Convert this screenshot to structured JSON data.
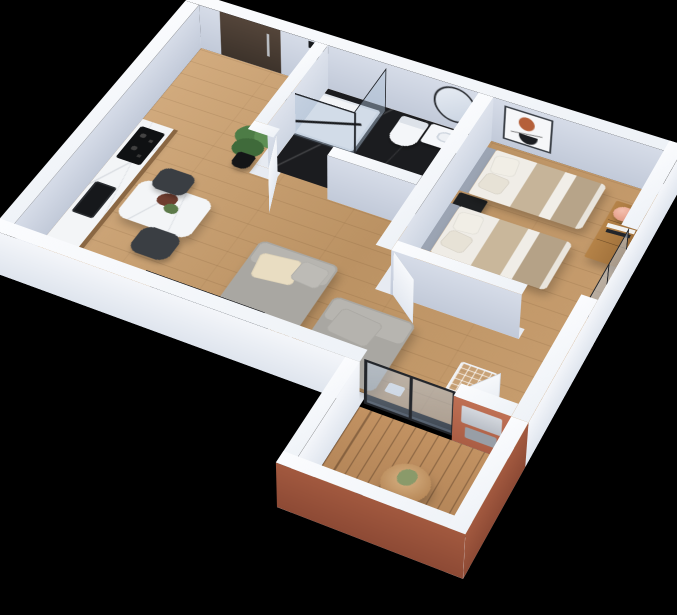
{
  "scene": {
    "kind": "3d-isometric-floor-plan-render",
    "background": "#000000",
    "rooms": [
      {
        "id": "entry-hall",
        "floor": "wood",
        "items": [
          "entrance-door",
          "potted-plant"
        ]
      },
      {
        "id": "bathroom",
        "floor": "black-marble",
        "items": [
          "walk-in-shower",
          "toilet",
          "vanity-sink",
          "round-mirror",
          "bathroom-door"
        ]
      },
      {
        "id": "kitchen-dining",
        "floor": "wood",
        "items": [
          "marble-counter",
          "cooktop",
          "sink",
          "dining-table",
          "flowers",
          "chair",
          "chair"
        ]
      },
      {
        "id": "living-room",
        "floor": "wood",
        "items": [
          "lounge-sofa",
          "lounge-sofa",
          "wire-coffee-table",
          "wire-side-table",
          "tv-panel",
          "balcony-door"
        ]
      },
      {
        "id": "bedroom",
        "floor": "wood",
        "items": [
          "single-bed",
          "single-bed",
          "nightstand",
          "dresser",
          "table-lamp",
          "photo-frames",
          "wall-art",
          "window"
        ]
      },
      {
        "id": "balcony",
        "floor": "deck",
        "items": [
          "round-table",
          "dried-plant",
          "lounge-chair",
          "ac-unit",
          "glass-doors"
        ]
      }
    ]
  },
  "palette": {
    "background": "#000000",
    "wall_top": "#f8fafc",
    "wall_footprint": "#e7ebf2",
    "wall_inner": "#c7cfdd",
    "wall_outer": "#edf1f7",
    "wood_floor": "#c69d70",
    "bath_floor": "#1b1c1f",
    "deck_floor": "#b4865a",
    "terracotta": "#b5674c",
    "terracotta_dark": "#9a5540",
    "door_wood": "#473a31",
    "frame_dark": "#23262b",
    "glass": "rgba(170,190,212,0.5)",
    "counter_marble": "#f3f5f7",
    "cabinet_wood": "#8a6743",
    "appliance_black": "#111316",
    "chair_dark": "#3a3e43",
    "sofa_gray": "#a9a7a2",
    "sofa_light": "#b7b5b0",
    "pillow_cream": "#e9ddc2",
    "bed_white": "#efece6",
    "bed_beige": "#c2b096",
    "headboard_gray": "#9ba4b3",
    "nightstand_black": "#1d1f21",
    "dresser_wood": "#a8773f",
    "lamp_salmon": "#e8a18b",
    "art_accent": "#b5603a",
    "tv_slate": "#343b44",
    "wire_white": "#f2f4f7",
    "plant_green": "#4d7c46",
    "white": "#f5f7fa",
    "cushion_white": "#eef0f2"
  }
}
